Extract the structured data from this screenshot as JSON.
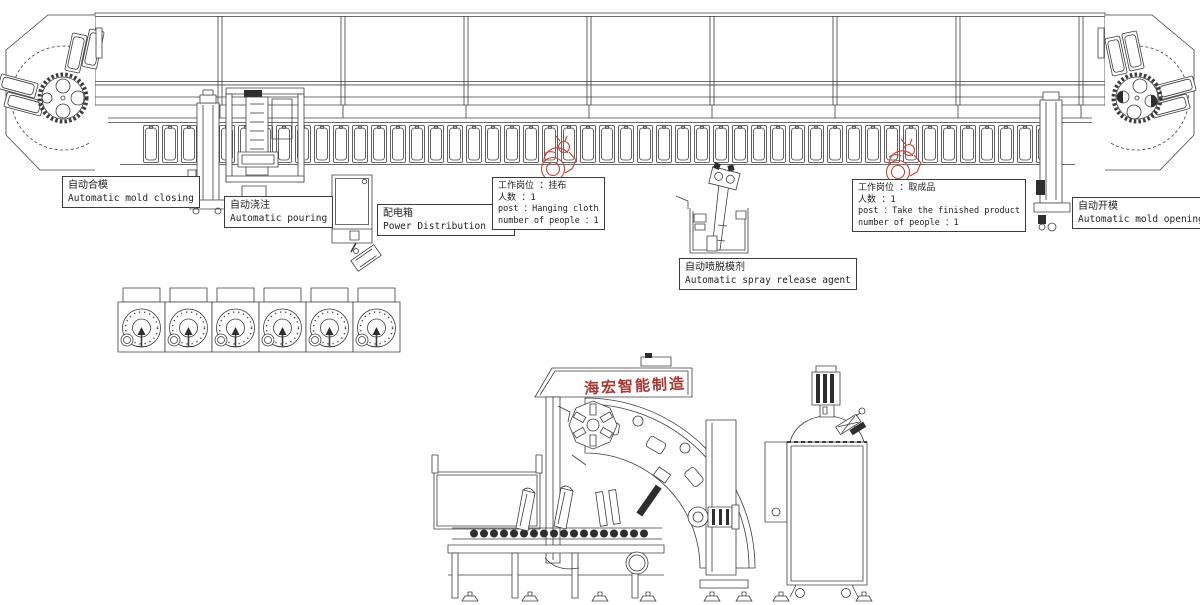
{
  "diagram": {
    "type": "factory-production-line-cad-drawing",
    "colors": {
      "line": "#3c3c3c",
      "red_accent": "#c44237",
      "watermark_red": "#a73833",
      "background": "#ffffff"
    },
    "watermark": "海宏智能制造",
    "labels": {
      "mold_closing": {
        "zh": "自动合模",
        "en": "Automatic mold closing"
      },
      "pouring": {
        "zh": "自动浇注",
        "en": "Automatic pouring"
      },
      "power_box": {
        "zh": "配电箱",
        "en": "Power Distribution Box"
      },
      "post_hanging": {
        "line1": "工作岗位 ：挂布",
        "line2": "人数 ：1",
        "line3": "post ：Hanging cloth",
        "line4": "number of people ：1"
      },
      "spray_agent": {
        "zh": "自动喷脱模剂",
        "en": "Automatic spray release agent"
      },
      "post_finished": {
        "line1": "工作岗位 ：取成品",
        "line2": "人数 ：1",
        "line3": "post ：Take the finished product",
        "line4": "number of people ：1"
      },
      "mold_opening": {
        "zh": "自动开模",
        "en": "Automatic mold opening"
      }
    },
    "markers": [
      {
        "name": "worker-hanging-cloth",
        "color": "#c44237"
      },
      {
        "name": "worker-take-finished-product",
        "color": "#c44237"
      }
    ]
  }
}
